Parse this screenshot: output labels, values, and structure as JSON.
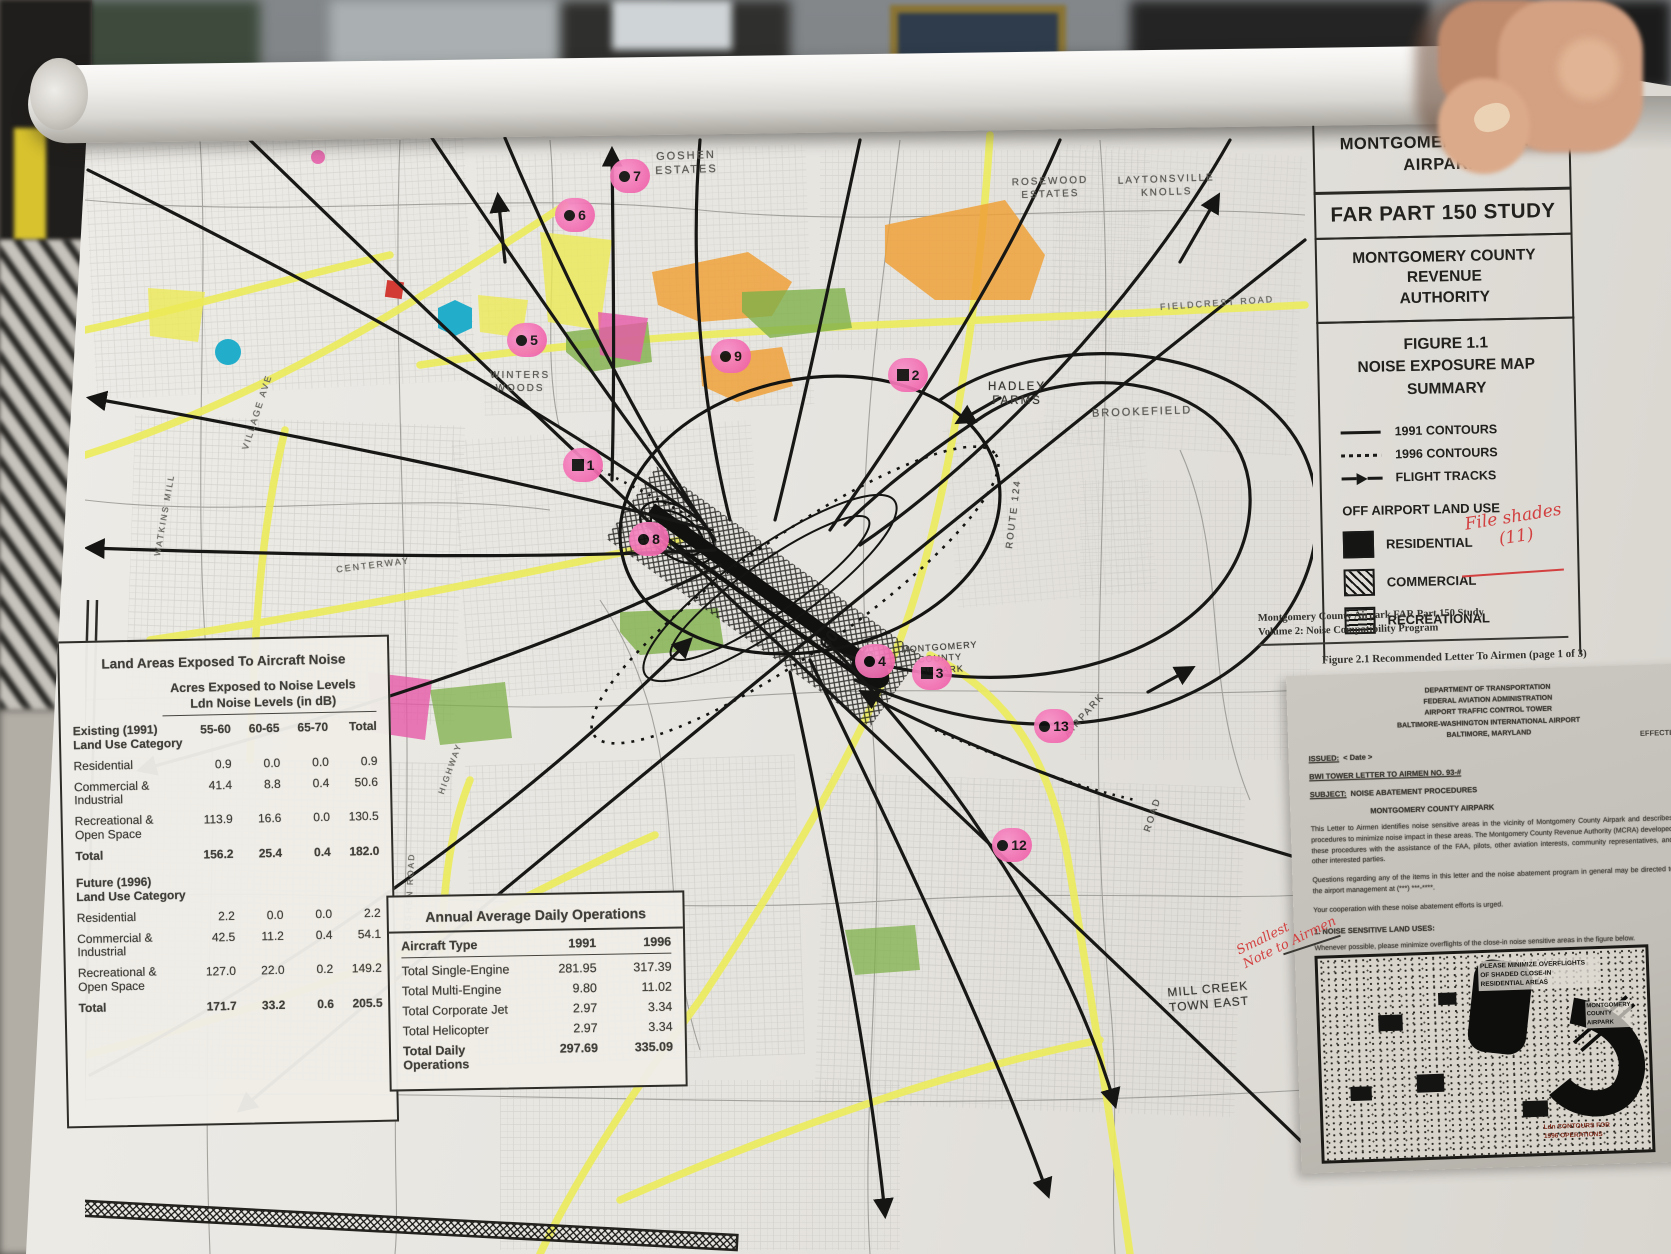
{
  "title_block": {
    "airport": "MONTGOMERY COUNTY\nAIRPARK",
    "study": "FAR PART 150 STUDY",
    "authority": "MONTGOMERY COUNTY\nREVENUE\nAUTHORITY",
    "figure": "FIGURE 1.1\nNOISE EXPOSURE MAP\nSUMMARY"
  },
  "legend": {
    "items": [
      {
        "label": "1991 CONTOURS",
        "symbol": "solid-line"
      },
      {
        "label": "1996 CONTOURS",
        "symbol": "dotted-line"
      },
      {
        "label": "FLIGHT TRACKS",
        "symbol": "arrow-line"
      }
    ],
    "land_use_heading": "OFF AIRPORT LAND USE",
    "land_use": [
      {
        "label": "RESIDENTIAL",
        "symbol": "solid-black-square"
      },
      {
        "label": "COMMERCIAL",
        "symbol": "diagonal-hatch-square"
      },
      {
        "label": "RECREATIONAL",
        "symbol": "wavy-lines-square"
      }
    ],
    "handwritten_note": "File shades\n(11)",
    "note_color": "#d24040"
  },
  "map": {
    "colors": {
      "road_highlight_yellow": "#ecec5e",
      "zone_orange": "#efa13a",
      "zone_green": "#7fb04a",
      "zone_magenta": "#e659a8",
      "marker_pink": "#f475b5",
      "flight_track": "#171717",
      "annotation_red": "#d24040"
    },
    "labels": [
      {
        "name": "goshen-estates",
        "text": "GOSHEN\nESTATES"
      },
      {
        "name": "rosewood-estates",
        "text": "ROSEWOOD\nESTATES"
      },
      {
        "name": "laytonsville-knolls",
        "text": "LAYTONSVILLE\nKNOLLS"
      },
      {
        "name": "fieldcrest-road",
        "text": "FIELDCREST   ROAD"
      },
      {
        "name": "hadley-farms",
        "text": "HADLEY\nFARMS"
      },
      {
        "name": "brookefield",
        "text": "BROOKEFIELD"
      },
      {
        "name": "winters-woods",
        "text": "WINTERS\nWOODS"
      },
      {
        "name": "village-ave",
        "text": "VILLAGE  AVE"
      },
      {
        "name": "watkins-mill",
        "text": "WATKINS MILL"
      },
      {
        "name": "centerway",
        "text": "CENTERWAY"
      },
      {
        "name": "route-124",
        "text": "ROUTE  124"
      },
      {
        "name": "airpark",
        "text": "AIRPARK"
      },
      {
        "name": "road",
        "text": "ROAD"
      },
      {
        "name": "goshen-road",
        "text": "GOSHEN ROAD"
      },
      {
        "name": "highway",
        "text": "HIGHWAY"
      },
      {
        "name": "montgomery-county-airpark",
        "text": "MONTGOMERY\nCOUNTY\nAIRPARK"
      },
      {
        "name": "mill-creek-town-east",
        "text": "MILL CREEK\nTOWN EAST"
      },
      {
        "name": "contour-60",
        "text": "60"
      },
      {
        "name": "contour-55",
        "text": "55"
      }
    ],
    "markers": [
      {
        "number": "1",
        "shape": "square"
      },
      {
        "number": "2",
        "shape": "square"
      },
      {
        "number": "3",
        "shape": "square"
      },
      {
        "number": "4",
        "shape": "dot"
      },
      {
        "number": "5",
        "shape": "dot"
      },
      {
        "number": "6",
        "shape": "dot"
      },
      {
        "number": "7",
        "shape": "dot"
      },
      {
        "number": "8",
        "shape": "dot"
      },
      {
        "number": "9",
        "shape": "dot"
      },
      {
        "number": "12",
        "shape": "dot"
      },
      {
        "number": "13",
        "shape": "dot"
      }
    ]
  },
  "noise_table": {
    "title": "Land Areas Exposed To Aircraft Noise",
    "subtitle": "Acres Exposed to Noise Levels\nLdn Noise Levels (in dB)",
    "col_headers": [
      "55-60",
      "60-65",
      "65-70",
      "Total"
    ],
    "sections": [
      {
        "heading": "Existing (1991)\nLand Use Category",
        "rows": [
          {
            "label": "Residential",
            "values": [
              "0.9",
              "0.0",
              "0.0",
              "0.9"
            ]
          },
          {
            "label": "Commercial &\nIndustrial",
            "values": [
              "41.4",
              "8.8",
              "0.4",
              "50.6"
            ]
          },
          {
            "label": "Recreational &\nOpen Space",
            "values": [
              "113.9",
              "16.6",
              "0.0",
              "130.5"
            ]
          },
          {
            "label": "Total",
            "values": [
              "156.2",
              "25.4",
              "0.4",
              "182.0"
            ]
          }
        ]
      },
      {
        "heading": "Future (1996)\nLand Use Category",
        "rows": [
          {
            "label": "Residential",
            "values": [
              "2.2",
              "0.0",
              "0.0",
              "2.2"
            ]
          },
          {
            "label": "Commercial &\nIndustrial",
            "values": [
              "42.5",
              "11.2",
              "0.4",
              "54.1"
            ]
          },
          {
            "label": "Recreational &\nOpen Space",
            "values": [
              "127.0",
              "22.0",
              "0.2",
              "149.2"
            ]
          },
          {
            "label": "Total",
            "values": [
              "171.7",
              "33.2",
              "0.6",
              "205.5"
            ]
          }
        ]
      }
    ]
  },
  "ops_table": {
    "title": "Annual Average Daily Operations",
    "col_headers": [
      "Aircraft Type",
      "1991",
      "1996"
    ],
    "rows": [
      {
        "label": "Total Single-Engine",
        "values": [
          "281.95",
          "317.39"
        ]
      },
      {
        "label": "Total Multi-Engine",
        "values": [
          "9.80",
          "11.02"
        ]
      },
      {
        "label": "Total Corporate Jet",
        "values": [
          "2.97",
          "3.34"
        ]
      },
      {
        "label": "Total Helicopter",
        "values": [
          "2.97",
          "3.34"
        ]
      },
      {
        "label": "Total Daily Operations",
        "values": [
          "297.69",
          "335.09"
        ]
      }
    ]
  },
  "attachment": {
    "source_line": "Montgomery County Airpark FAR Part 150 Study\nVolume 2: Noise Compatibility Program",
    "figure_caption": "Figure 2.1 Recommended Letter To Airmen (page 1 of 3)",
    "letterhead": "DEPARTMENT OF TRANSPORTATION\nFEDERAL AVIATION ADMINISTRATION\nAIRPORT TRAFFIC CONTROL TOWER\nBALTIMORE-WASHINGTON INTERNATIONAL AIRPORT\nBALTIMORE, MARYLAND",
    "issued_label": "ISSUED:",
    "issued_value": "< Date >",
    "effective_label": "EFFECTIVE",
    "letter_no": "BWI TOWER LETTER TO AIRMEN NO. 93-#",
    "subject_label": "SUBJECT:",
    "subject_line1": "NOISE ABATEMENT PROCEDURES",
    "subject_line2": "MONTGOMERY COUNTY AIRPARK",
    "body1": "This Letter to Airmen identifies noise sensitive areas in the vicinity of Montgomery County Airpark and describes procedures to minimize noise impact in these areas.  The Montgomery County Revenue Authority (MCRA) developed these procedures with the assistance of the FAA, pilots, other aviation interests, community representatives, and other interested parties.",
    "body2": "Questions regarding any of the items in this letter and the noise abatement program in general may be directed to the airport management at (***) ***-****.",
    "body3": "Your cooperation with these noise abatement efforts is urged.",
    "item1": "1.      NOISE SENSITIVE LAND USES:",
    "item1_text": "Whenever possible, please minimize overflights of the close-in noise sensitive areas in the figure below.",
    "inset_note": "PLEASE MINIMIZE OVERFLIGHTS\nOF SHADED CLOSE-IN\nRESIDENTIAL AREAS",
    "inset_airport": "MONTGOMERY\nCOUNTY\nAIRPARK",
    "inset_caption": "Ldn CONTOURS FOR\n1996 OPERATIONS",
    "handwritten_note": "Smallest\nNote to Airmen"
  }
}
